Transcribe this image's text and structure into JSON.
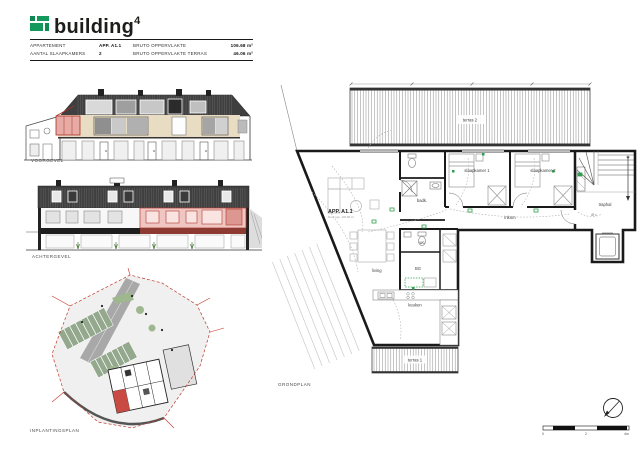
{
  "header": {
    "logo_text": "building",
    "logo_superscript": "4"
  },
  "info_table": {
    "rows": [
      {
        "label1": "APPARTEMENT",
        "value1": "APP. A1.1",
        "label2": "BRUTO OPPERVLAKTE",
        "value2": "106.68 m²"
      },
      {
        "label1": "AANTAL SLAAPKAMERS",
        "value1": "2",
        "label2": "BRUTO OPPERVLAKTE TERRAS",
        "value2": "46.06 m²"
      }
    ]
  },
  "elevations": {
    "voorgevel_label": "VOORGEVEL",
    "achtergevel_label": "ACHTERGEVEL"
  },
  "site_plan": {
    "label": "INPLANTINGSPLAN"
  },
  "floor_plan": {
    "label": "GRONDPLAN",
    "apartment": {
      "id": "APP. A1.1",
      "sub": "bruto opp. 106.68 m²"
    },
    "rooms": {
      "terras_2": "terras 2",
      "terras_1": "terras 1",
      "living": "living",
      "keuken": "keuken",
      "badkamer": "badk.",
      "wc": "wc",
      "berging": "BG",
      "inkom": "inkom",
      "slaapkamer_1": "slaapkamer 1",
      "slaapkamer_2": "slaapkamer 2",
      "traphal": "traphal"
    },
    "traphal_marks": "Ø ×"
  },
  "scale_bar": {
    "ticks": [
      "0",
      "2",
      "4m"
    ]
  },
  "colors": {
    "brand_green": "#12995b",
    "highlight_red": "#b03a30",
    "highlight_pink": "#f0c6c2",
    "roof_dark": "#3f3f3f",
    "wall_beige": "#e8dcc3",
    "plan_green": "#2f9e4f"
  }
}
